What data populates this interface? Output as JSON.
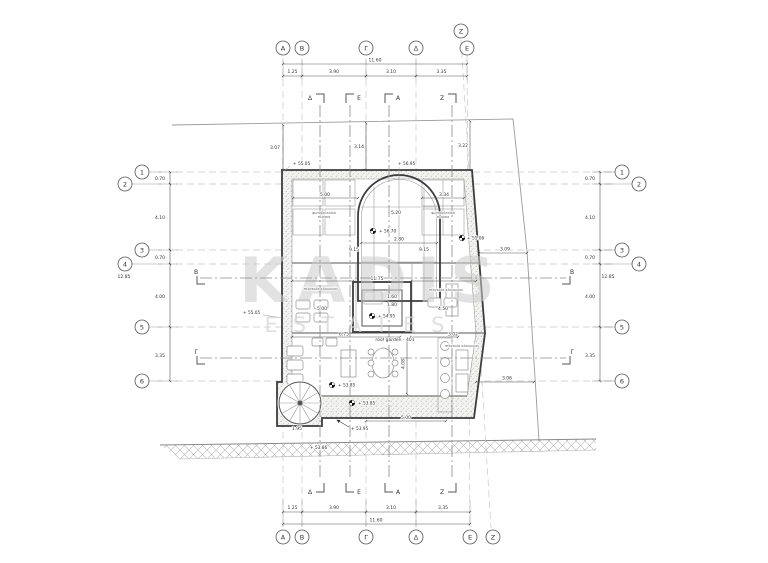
{
  "watermark": {
    "line1": "KADIS",
    "line2": "ESTATES"
  },
  "grid": {
    "cols": {
      "a": "A",
      "b": "B",
      "g": "Γ",
      "d": "Δ",
      "e": "E",
      "z": "Z"
    },
    "rows": {
      "r1": "1",
      "r2": "2",
      "r3": "3",
      "r4": "4",
      "r5": "5",
      "r6": "6"
    }
  },
  "sections": {
    "d": "Δ",
    "e": "E",
    "a": "A",
    "z": "Z",
    "b": "B",
    "g": "Γ"
  },
  "dims": {
    "h_total": "11.60",
    "h1": "1.25",
    "h2": "3.90",
    "h3": "3.10",
    "h4": "3.35",
    "v_total": "12.85",
    "v1": "0.70",
    "v2": "4.10",
    "v3": "0.70",
    "v4": "4.00",
    "v5": "3.35",
    "off_a": "3.07",
    "off_g": "3.14",
    "off_e": "3.22",
    "off_r1": "3.09",
    "off_r2": "3.06",
    "pv_l": "5.00",
    "pv_r": "3.34",
    "vault_h": "5.20",
    "vault_w": "2.80",
    "side": "9.15",
    "inner_w": "11.75",
    "room_l": "5.00",
    "room_r": "4.50",
    "room_rb": "3.02",
    "core_w": "1.60",
    "core_h": "1.80",
    "garden_w": "6.75",
    "garden_h": "4.08",
    "bottom": "5.00",
    "spiral": "1.95"
  },
  "levels": {
    "top_left": "+ 55.05",
    "top_mid": "+ 56.95",
    "vault": "+ 56.70",
    "mid_left": "+ 55.05",
    "mid_right": "+ 55.06",
    "core": "+ 54.95",
    "garden_a": "+ 53.85",
    "garden_b": "+ 53.85",
    "strip": "+ 53.95",
    "street": "+ 53.86"
  },
  "labels": {
    "roof_garden": "roof garden - 401",
    "pv_1": "φωτοβολταϊκά",
    "pv_2": "πλαίσια",
    "pergola": "πέργκολα αλουμινίου"
  }
}
